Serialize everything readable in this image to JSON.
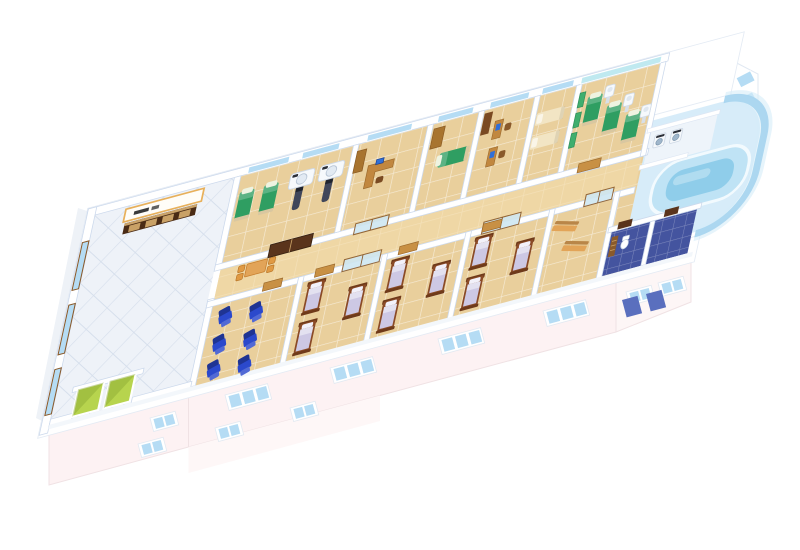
{
  "scene": {
    "subject": "3D isometric cutaway floor plan of a hospital / rehabilitation ward floor on a white background",
    "background": "#ffffff",
    "projection": "axonometric, building runs lower-left to upper-right"
  },
  "palette": {
    "wall": "#ffffff",
    "wall_edge": "#ccd9ec",
    "floor_tile": "#e9cf9c",
    "corridor_floor": "#f2dcab",
    "lobby_floor": "#eef2f8",
    "bathroom_floor": "#44549f",
    "pool_deck": "#d7ecf9",
    "pool_rim": "#bfe3f5",
    "pool_water": "#8fcdea",
    "glass_blue": "#a5d4ee",
    "window_glass": "#b5dcf4",
    "cyan_glass": "#bfe9f0",
    "facade_tint": "#fdf2f3",
    "facade_tint2": "#fef7f7",
    "dark_glass": "#5a6fbe",
    "exam_bed_green": "#2f9e62",
    "physio_screen_green": "#3fae6e",
    "daybed_cream": "#f2e5c4",
    "ward_bedding": "#cdc8e4",
    "ward_frame": "#8a4a26",
    "recliner_blue": "#2b49cc",
    "bench_wood": "#e2a458",
    "desk_wood": "#c1873f",
    "cabinet_wood": "#a8742f",
    "door_wood": "#c89044",
    "door_dark": "#5a341c",
    "elevator_green": "#b7d44e",
    "monitor_blue": "#2f6fd8",
    "machine_white": "#f6f9fc",
    "sign_trim": "#e8b05a",
    "sign_face": "#fffdf8",
    "reception_dark": "#4a2b15",
    "reception_panel": "#c9a166"
  },
  "reception_sign": {
    "text_visible": true,
    "text_legible": false,
    "text": ""
  },
  "rooms": [
    {
      "id": "lobby",
      "name": "entrance lobby",
      "furniture": {
        "reception_desk": 1,
        "wall_sign": 1,
        "elevator_cells": 2,
        "side_windows": 3
      }
    },
    {
      "id": "imaging",
      "name": "imaging room",
      "furniture": {
        "green_exam_beds": 2,
        "scanner_machines": 2,
        "double_door": 1
      }
    },
    {
      "id": "office",
      "name": "consultation office",
      "furniture": {
        "l_desk": 1,
        "computer": 1,
        "cabinet": 1,
        "glass_door": 1
      }
    },
    {
      "id": "treatment",
      "name": "treatment room",
      "furniture": {
        "green_bed": 1,
        "wardrobe": 1
      }
    },
    {
      "id": "nurse-office",
      "name": "nurse office",
      "furniture": {
        "desks": 2,
        "computers": 2,
        "cabinet": 1
      }
    },
    {
      "id": "exam",
      "name": "exam room",
      "furniture": {
        "cream_daybeds": 2
      }
    },
    {
      "id": "physio",
      "name": "physiotherapy room",
      "furniture": {
        "green_tables": 3,
        "white_machines": 3,
        "green_screens": 3
      }
    },
    {
      "id": "laundry",
      "name": "utility / laundry room",
      "furniture": {
        "washing_machines": 2
      }
    },
    {
      "id": "hydrotherapy",
      "name": "hydrotherapy pool area",
      "furniture": {
        "curved_pool": 1,
        "curved_glass_wall": 1
      }
    },
    {
      "id": "infusion",
      "name": "infusion / recliner room",
      "furniture": {
        "blue_recliners": 6
      }
    },
    {
      "id": "ward-1",
      "name": "patient ward 1",
      "furniture": {
        "beds": 3
      }
    },
    {
      "id": "ward-2",
      "name": "patient ward 2",
      "furniture": {
        "beds": 3
      }
    },
    {
      "id": "ward-3",
      "name": "patient ward 3",
      "furniture": {
        "beds": 3
      }
    },
    {
      "id": "waiting",
      "name": "waiting area",
      "furniture": {
        "wood_benches": 2
      }
    },
    {
      "id": "bathrooms",
      "name": "bathrooms (dark blue tile)",
      "furniture": {
        "toilet": 1,
        "radiator": 1,
        "rooms": 2
      }
    },
    {
      "id": "corridor",
      "name": "central corridor",
      "furniture": {
        "table": 1,
        "chairs": 4,
        "glass_doors": 3
      }
    }
  ],
  "facade": {
    "main_window_groups": 4,
    "lower_row_windows": 2,
    "lobby_windows": 2,
    "right_end_windows": 2,
    "dark_glass_blocks": 2,
    "upper_right_block_windows": 2
  }
}
